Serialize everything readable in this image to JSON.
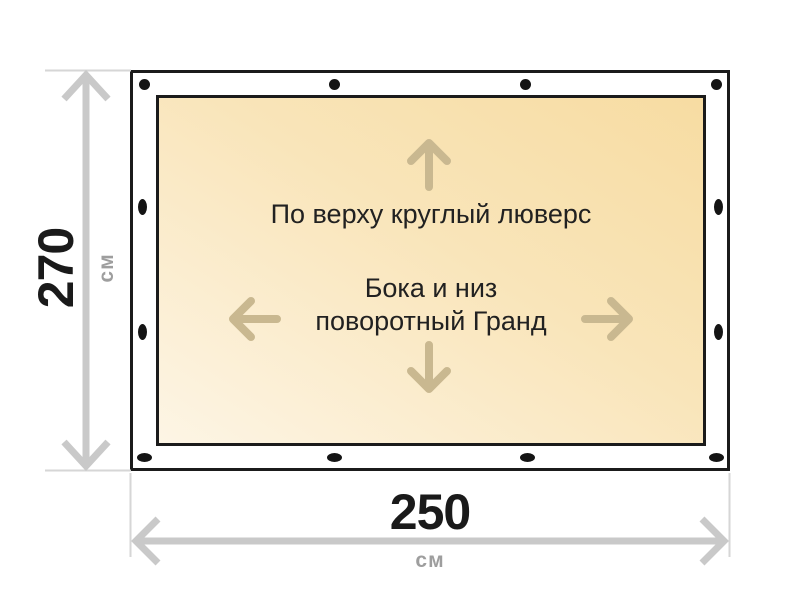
{
  "diagram": {
    "annotations": {
      "top_fastening": "По верху круглый люверс",
      "side_fastening_line1": "Бока и низ",
      "side_fastening_line2": "поворотный Гранд"
    },
    "dimensions": {
      "height": {
        "value": "270",
        "unit": "см"
      },
      "width": {
        "value": "250",
        "unit": "см"
      }
    },
    "grommets": {
      "top_count": 4,
      "bottom_count": 4,
      "left_count": 2,
      "right_count": 2
    },
    "icons": {
      "grommet": "grommet-icon",
      "direction_arrows": [
        "arrow-up-icon",
        "arrow-down-icon",
        "arrow-left-icon",
        "arrow-right-icon"
      ],
      "dimension_arrows": [
        "height-double-arrow-icon",
        "width-double-arrow-icon"
      ]
    },
    "colors": {
      "fabric_gradient_start": "#f7dca2",
      "fabric_gradient_end": "#fdf5e5",
      "direction_arrow": "#c9b890",
      "dimension_line": "#c9c9c9",
      "extension_line": "#d6d6d6",
      "panel_border": "#1b1b1b",
      "grommet": "#141414",
      "dimension_value": "#1a1a1a",
      "dimension_unit": "#9e9e9e",
      "annotation_text": "#212121"
    }
  }
}
